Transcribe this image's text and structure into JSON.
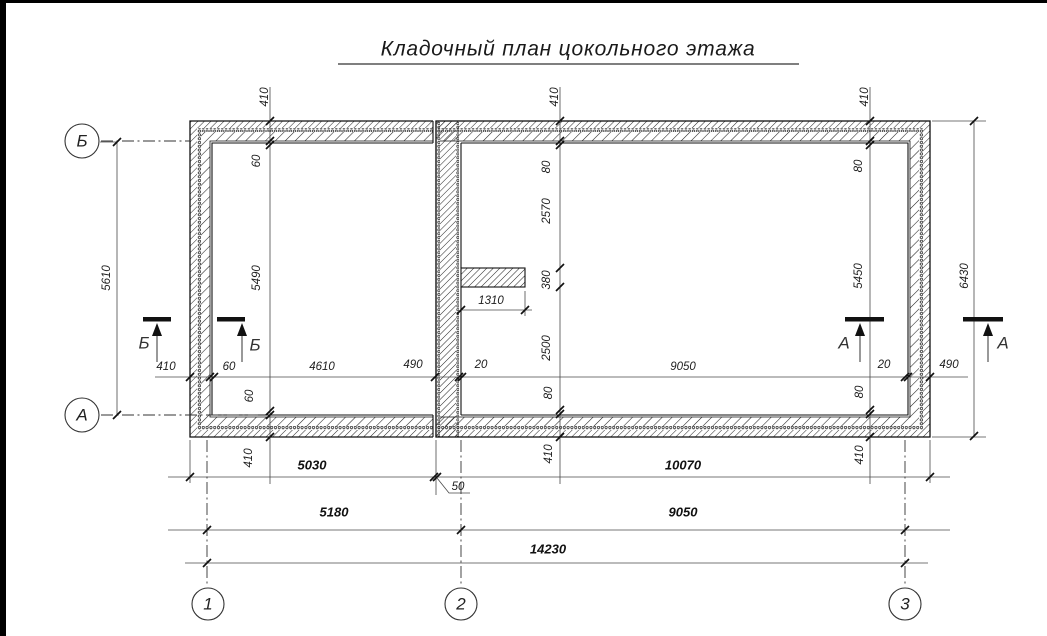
{
  "title": "Кладочный план цокольного этажа",
  "drawing": {
    "axis_bubbles": [
      {
        "label": "Б"
      },
      {
        "label": "А"
      },
      {
        "label": "1"
      },
      {
        "label": "2"
      },
      {
        "label": "3"
      }
    ],
    "section_marks": [
      {
        "label": "Б"
      },
      {
        "label": "Б"
      },
      {
        "label": "А"
      },
      {
        "label": "А"
      }
    ],
    "dimensions": {
      "top_wall_thickness": [
        "410",
        "410",
        "410"
      ],
      "left_overall": "5610",
      "right_overall": "6430",
      "left_room_vertical": [
        "60",
        "5490",
        "60",
        "410"
      ],
      "axis2_vertical": [
        "80",
        "2570",
        "380",
        "2500",
        "80",
        "410"
      ],
      "right_room_vertical": [
        "80",
        "5450",
        "80",
        "410"
      ],
      "pilaster_length": "1310",
      "inner_horizontal": [
        "410",
        "60",
        "4610",
        "490",
        "20",
        "9050",
        "20",
        "490"
      ],
      "outer_widths": [
        "5030",
        "10070"
      ],
      "joint": "50",
      "axis_spans": [
        "5180",
        "9050"
      ],
      "total": "14230"
    }
  }
}
